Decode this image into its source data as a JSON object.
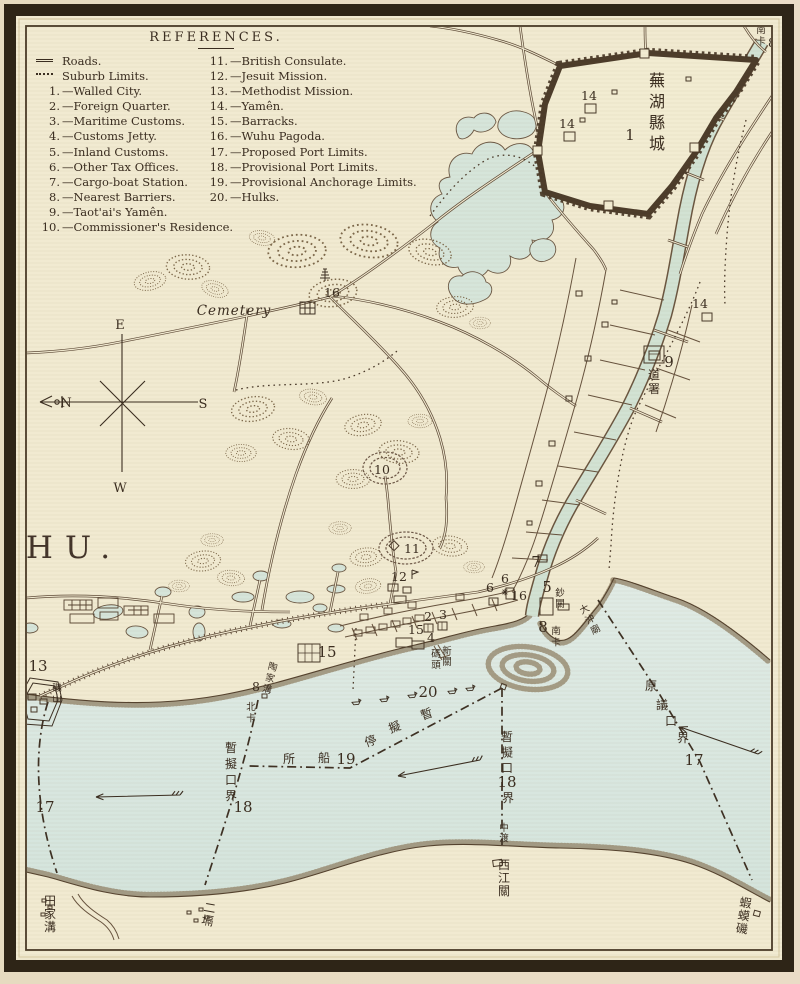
{
  "page": {
    "width": 800,
    "height": 984
  },
  "colors": {
    "paper": "#f1ead1",
    "water": "#dbe7e0",
    "creek": "#d2e2d3",
    "ink": "#3a2d20",
    "wall": "#4c3c2a",
    "frame": "#2e2517",
    "hills": "#7b6749"
  },
  "legend": {
    "title": "REFERENCES.",
    "left": [
      {
        "sym": "roads",
        "label": "Roads."
      },
      {
        "sym": "dots",
        "label": "Suburb Limits."
      },
      {
        "num": "1.",
        "label": "—Walled City."
      },
      {
        "num": "2.",
        "label": "—Foreign Quarter."
      },
      {
        "num": "3.",
        "label": "—Maritime Customs."
      },
      {
        "num": "4.",
        "label": "—Customs Jetty."
      },
      {
        "num": "5.",
        "label": "—Inland Customs."
      },
      {
        "num": "6.",
        "label": "—Other Tax Offices."
      },
      {
        "num": "7.",
        "label": "—Cargo-boat Station."
      },
      {
        "num": "8.",
        "label": "—Nearest Barriers."
      },
      {
        "num": "9.",
        "label": "—Taot'ai's Yamên."
      },
      {
        "num": "10.",
        "label": "—Commissioner's Residence."
      }
    ],
    "right": [
      {
        "num": "11.",
        "label": "—British Consulate."
      },
      {
        "num": "12.",
        "label": "—Jesuit Mission."
      },
      {
        "num": "13.",
        "label": "—Methodist Mission."
      },
      {
        "num": "14.",
        "label": "—Yamên."
      },
      {
        "num": "15.",
        "label": "—Barracks."
      },
      {
        "num": "16.",
        "label": "—Wuhu Pagoda."
      },
      {
        "num": "17.",
        "label": "—Proposed Port Limits."
      },
      {
        "num": "18.",
        "label": "—Provisional Port Limits."
      },
      {
        "num": "19.",
        "label": "—Provisional Anchorage Limits."
      },
      {
        "num": "20.",
        "label": "—Hulks."
      }
    ]
  },
  "map": {
    "labels": [
      {
        "n": "map-title",
        "t": "WUHU.",
        "x": 33,
        "y": 558,
        "c": "maptitle",
        "a": "start"
      },
      {
        "n": "city-name",
        "t": "蕪湖縣城",
        "x": 657,
        "y": 86,
        "c": "cjk-lg",
        "v": 1,
        "dy": 21
      },
      {
        "n": "marker-1",
        "t": "1",
        "x": 630,
        "y": 140,
        "c": "num-lg"
      },
      {
        "n": "marker-14a",
        "t": "14",
        "x": 589,
        "y": 100,
        "c": "num"
      },
      {
        "n": "marker-14b",
        "t": "14",
        "x": 567,
        "y": 128,
        "c": "num"
      },
      {
        "n": "marker-14c",
        "t": "14",
        "x": 700,
        "y": 308,
        "c": "num"
      },
      {
        "n": "nanka-top",
        "t": "南卡",
        "x": 761,
        "y": 33,
        "c": "cjk-sm",
        "v": 1,
        "dy": 11.5
      },
      {
        "n": "marker-8a",
        "t": "8",
        "x": 772,
        "y": 47,
        "c": "num"
      },
      {
        "n": "marker-9",
        "t": "9",
        "x": 669,
        "y": 367,
        "c": "num-lg"
      },
      {
        "n": "taotai-label",
        "t": "道署",
        "x": 654,
        "y": 379,
        "c": "cjk",
        "v": 1,
        "dy": 14
      },
      {
        "n": "cemetery-label",
        "t": "Cemetery",
        "x": 234,
        "y": 315,
        "c": "cemetery",
        "a": "start"
      },
      {
        "n": "marker-16a",
        "t": "16",
        "x": 332,
        "y": 297,
        "c": "num"
      },
      {
        "n": "marker-10",
        "t": "10",
        "x": 382,
        "y": 474,
        "c": "num"
      },
      {
        "n": "marker-11",
        "t": "11",
        "x": 412,
        "y": 553,
        "c": "num"
      },
      {
        "n": "marker-12",
        "t": "12",
        "x": 399,
        "y": 581,
        "c": "num"
      },
      {
        "n": "marker-15a",
        "t": "15",
        "x": 416,
        "y": 634,
        "c": "num"
      },
      {
        "n": "marker-15b",
        "t": "15",
        "x": 327,
        "y": 657,
        "c": "num-lg"
      },
      {
        "n": "marker-2",
        "t": "2",
        "x": 428,
        "y": 621,
        "c": "num"
      },
      {
        "n": "marker-3",
        "t": "3",
        "x": 443,
        "y": 619,
        "c": "num"
      },
      {
        "n": "marker-4",
        "t": "4",
        "x": 431,
        "y": 642,
        "c": "num"
      },
      {
        "n": "jetty-name-right",
        "t": "新關",
        "x": 447,
        "y": 654,
        "c": "cjk-sm",
        "v": 1,
        "dy": 11
      },
      {
        "n": "jetty-name-left",
        "t": "碼頭",
        "x": 436,
        "y": 657,
        "c": "cjk-sm",
        "v": 1,
        "dy": 11
      },
      {
        "n": "marker-5",
        "t": "5",
        "x": 547,
        "y": 592,
        "c": "num-lg"
      },
      {
        "n": "chaoguan-label",
        "t": "鈔關",
        "x": 560,
        "y": 596,
        "c": "cjk-sm",
        "v": 1,
        "dy": 11
      },
      {
        "n": "marker-6a",
        "t": "6",
        "x": 505,
        "y": 583,
        "c": "num"
      },
      {
        "n": "marker-6b",
        "t": "6",
        "x": 490,
        "y": 592,
        "c": "num"
      },
      {
        "n": "marker-7",
        "t": "7",
        "x": 536,
        "y": 567,
        "c": "num-lg"
      },
      {
        "n": "marker-16b",
        "t": "16",
        "x": 519,
        "y": 600,
        "c": "num"
      },
      {
        "n": "marker-8c",
        "t": "8",
        "x": 543,
        "y": 632,
        "c": "num-lg"
      },
      {
        "n": "nanka-south",
        "t": "南卡",
        "x": 556,
        "y": 634,
        "c": "cjk-sm",
        "v": 1,
        "dy": 11.5
      },
      {
        "n": "dachongmiao-label",
        "t": "大沖廟",
        "x": 586,
        "y": 612,
        "c": "cjk-sm",
        "v": 1,
        "dy": 11.5,
        "r": -28
      },
      {
        "n": "marker-13",
        "t": "13",
        "x": 38,
        "y": 671,
        "c": "num-lg"
      },
      {
        "n": "jishan-label",
        "t": "磯山",
        "x": 57,
        "y": 691,
        "c": "cjk-sm",
        "v": 1,
        "dy": 11
      },
      {
        "n": "taojiagou-label",
        "t": "陶家溝",
        "x": 272,
        "y": 670,
        "c": "cjk-sm",
        "v": 1,
        "dy": 11.5,
        "r": 14
      },
      {
        "n": "marker-8b",
        "t": "8",
        "x": 256,
        "y": 691,
        "c": "num"
      },
      {
        "n": "beika-label",
        "t": "北卡",
        "x": 251,
        "y": 710,
        "c": "cjk-sm",
        "v": 1,
        "dy": 11.5
      },
      {
        "n": "marker-20",
        "t": "20",
        "x": 428,
        "y": 697,
        "c": "num-lg"
      },
      {
        "n": "anchorage-char-1",
        "t": "所",
        "x": 289,
        "y": 763,
        "c": "cjk"
      },
      {
        "n": "anchorage-char-2",
        "t": "船",
        "x": 324,
        "y": 762,
        "c": "cjk"
      },
      {
        "n": "marker-19",
        "t": "19",
        "x": 346,
        "y": 764,
        "c": "num-lg"
      },
      {
        "n": "anchorage-char-3",
        "t": "停",
        "x": 372,
        "y": 745,
        "c": "cjk",
        "r": -20
      },
      {
        "n": "anchorage-char-4",
        "t": "擬",
        "x": 396,
        "y": 731,
        "c": "cjk",
        "r": -20
      },
      {
        "n": "anchorage-char-5",
        "t": "暫",
        "x": 428,
        "y": 718,
        "c": "cjk",
        "r": -20
      },
      {
        "n": "prov-limit-left",
        "t": "暫擬口界",
        "x": 231,
        "y": 752,
        "c": "cjk",
        "v": 1,
        "dy": 16
      },
      {
        "n": "marker-18a",
        "t": "18",
        "x": 243,
        "y": 812,
        "c": "num-lg"
      },
      {
        "n": "prov-limit-right",
        "t": "暫擬口",
        "x": 507,
        "y": 741,
        "c": "cjk",
        "v": 1,
        "dy": 15.5
      },
      {
        "n": "marker-18b",
        "t": "18",
        "x": 507,
        "y": 787,
        "c": "num-lg"
      },
      {
        "n": "prov-limit-right-2",
        "t": "界",
        "x": 508,
        "y": 802,
        "c": "cjk"
      },
      {
        "n": "zhongdu-label",
        "t": "中渡",
        "x": 504,
        "y": 831,
        "c": "cjk-sm",
        "v": 1,
        "dy": 10.5
      },
      {
        "n": "orig-limit-left",
        "t": "原議口界",
        "x": 20,
        "y": 757,
        "c": "cjk",
        "v": 1,
        "dy": 17
      },
      {
        "n": "marker-17a",
        "t": "17",
        "x": 45,
        "y": 812,
        "c": "num-lg"
      },
      {
        "n": "orig-limit-r1",
        "t": "原",
        "x": 651,
        "y": 690,
        "c": "cjk"
      },
      {
        "n": "orig-limit-r2",
        "t": "議",
        "x": 662,
        "y": 709,
        "c": "cjk"
      },
      {
        "n": "orig-limit-r3",
        "t": "口",
        "x": 671,
        "y": 725,
        "c": "cjk"
      },
      {
        "n": "orig-limit-r4",
        "t": "界",
        "x": 683,
        "y": 742,
        "c": "cjk"
      },
      {
        "n": "marker-17b",
        "t": "17",
        "x": 694,
        "y": 765,
        "c": "num-lg"
      },
      {
        "n": "tianjiagou-label",
        "t": "田家溝",
        "x": 50,
        "y": 905,
        "c": "cjk",
        "v": 1,
        "dy": 13
      },
      {
        "n": "erge-label",
        "t": "二塥",
        "x": 209,
        "y": 912,
        "c": "cjk",
        "v": 1,
        "dy": 13,
        "r": 10
      },
      {
        "n": "xijiangguan-label",
        "t": "西江關",
        "x": 504,
        "y": 869,
        "c": "cjk",
        "v": 1,
        "dy": 13
      },
      {
        "n": "hamaji-label",
        "t": "蝦蟆磯",
        "x": 745,
        "y": 907,
        "c": "cjk",
        "v": 1,
        "dy": 13,
        "r": 8
      },
      {
        "n": "compass-e",
        "t": "E",
        "x": 120,
        "y": 329,
        "c": "compass"
      },
      {
        "n": "compass-w",
        "t": "W",
        "x": 120,
        "y": 492,
        "c": "compass"
      },
      {
        "n": "compass-n",
        "t": "N",
        "x": 66,
        "y": 407,
        "c": "compass"
      },
      {
        "n": "compass-s",
        "t": "S",
        "x": 203,
        "y": 408,
        "c": "compass"
      }
    ],
    "arrows": [
      {
        "x1": 480,
        "y1": 760,
        "x2": 398,
        "y2": 776
      },
      {
        "x1": 180,
        "y1": 795,
        "x2": 96,
        "y2": 797
      },
      {
        "x1": 758,
        "y1": 754,
        "x2": 680,
        "y2": 727
      }
    ],
    "hulks": [
      {
        "x": 356,
        "y": 702
      },
      {
        "x": 384,
        "y": 699
      },
      {
        "x": 412,
        "y": 695
      },
      {
        "x": 452,
        "y": 691
      },
      {
        "x": 470,
        "y": 688
      }
    ]
  }
}
